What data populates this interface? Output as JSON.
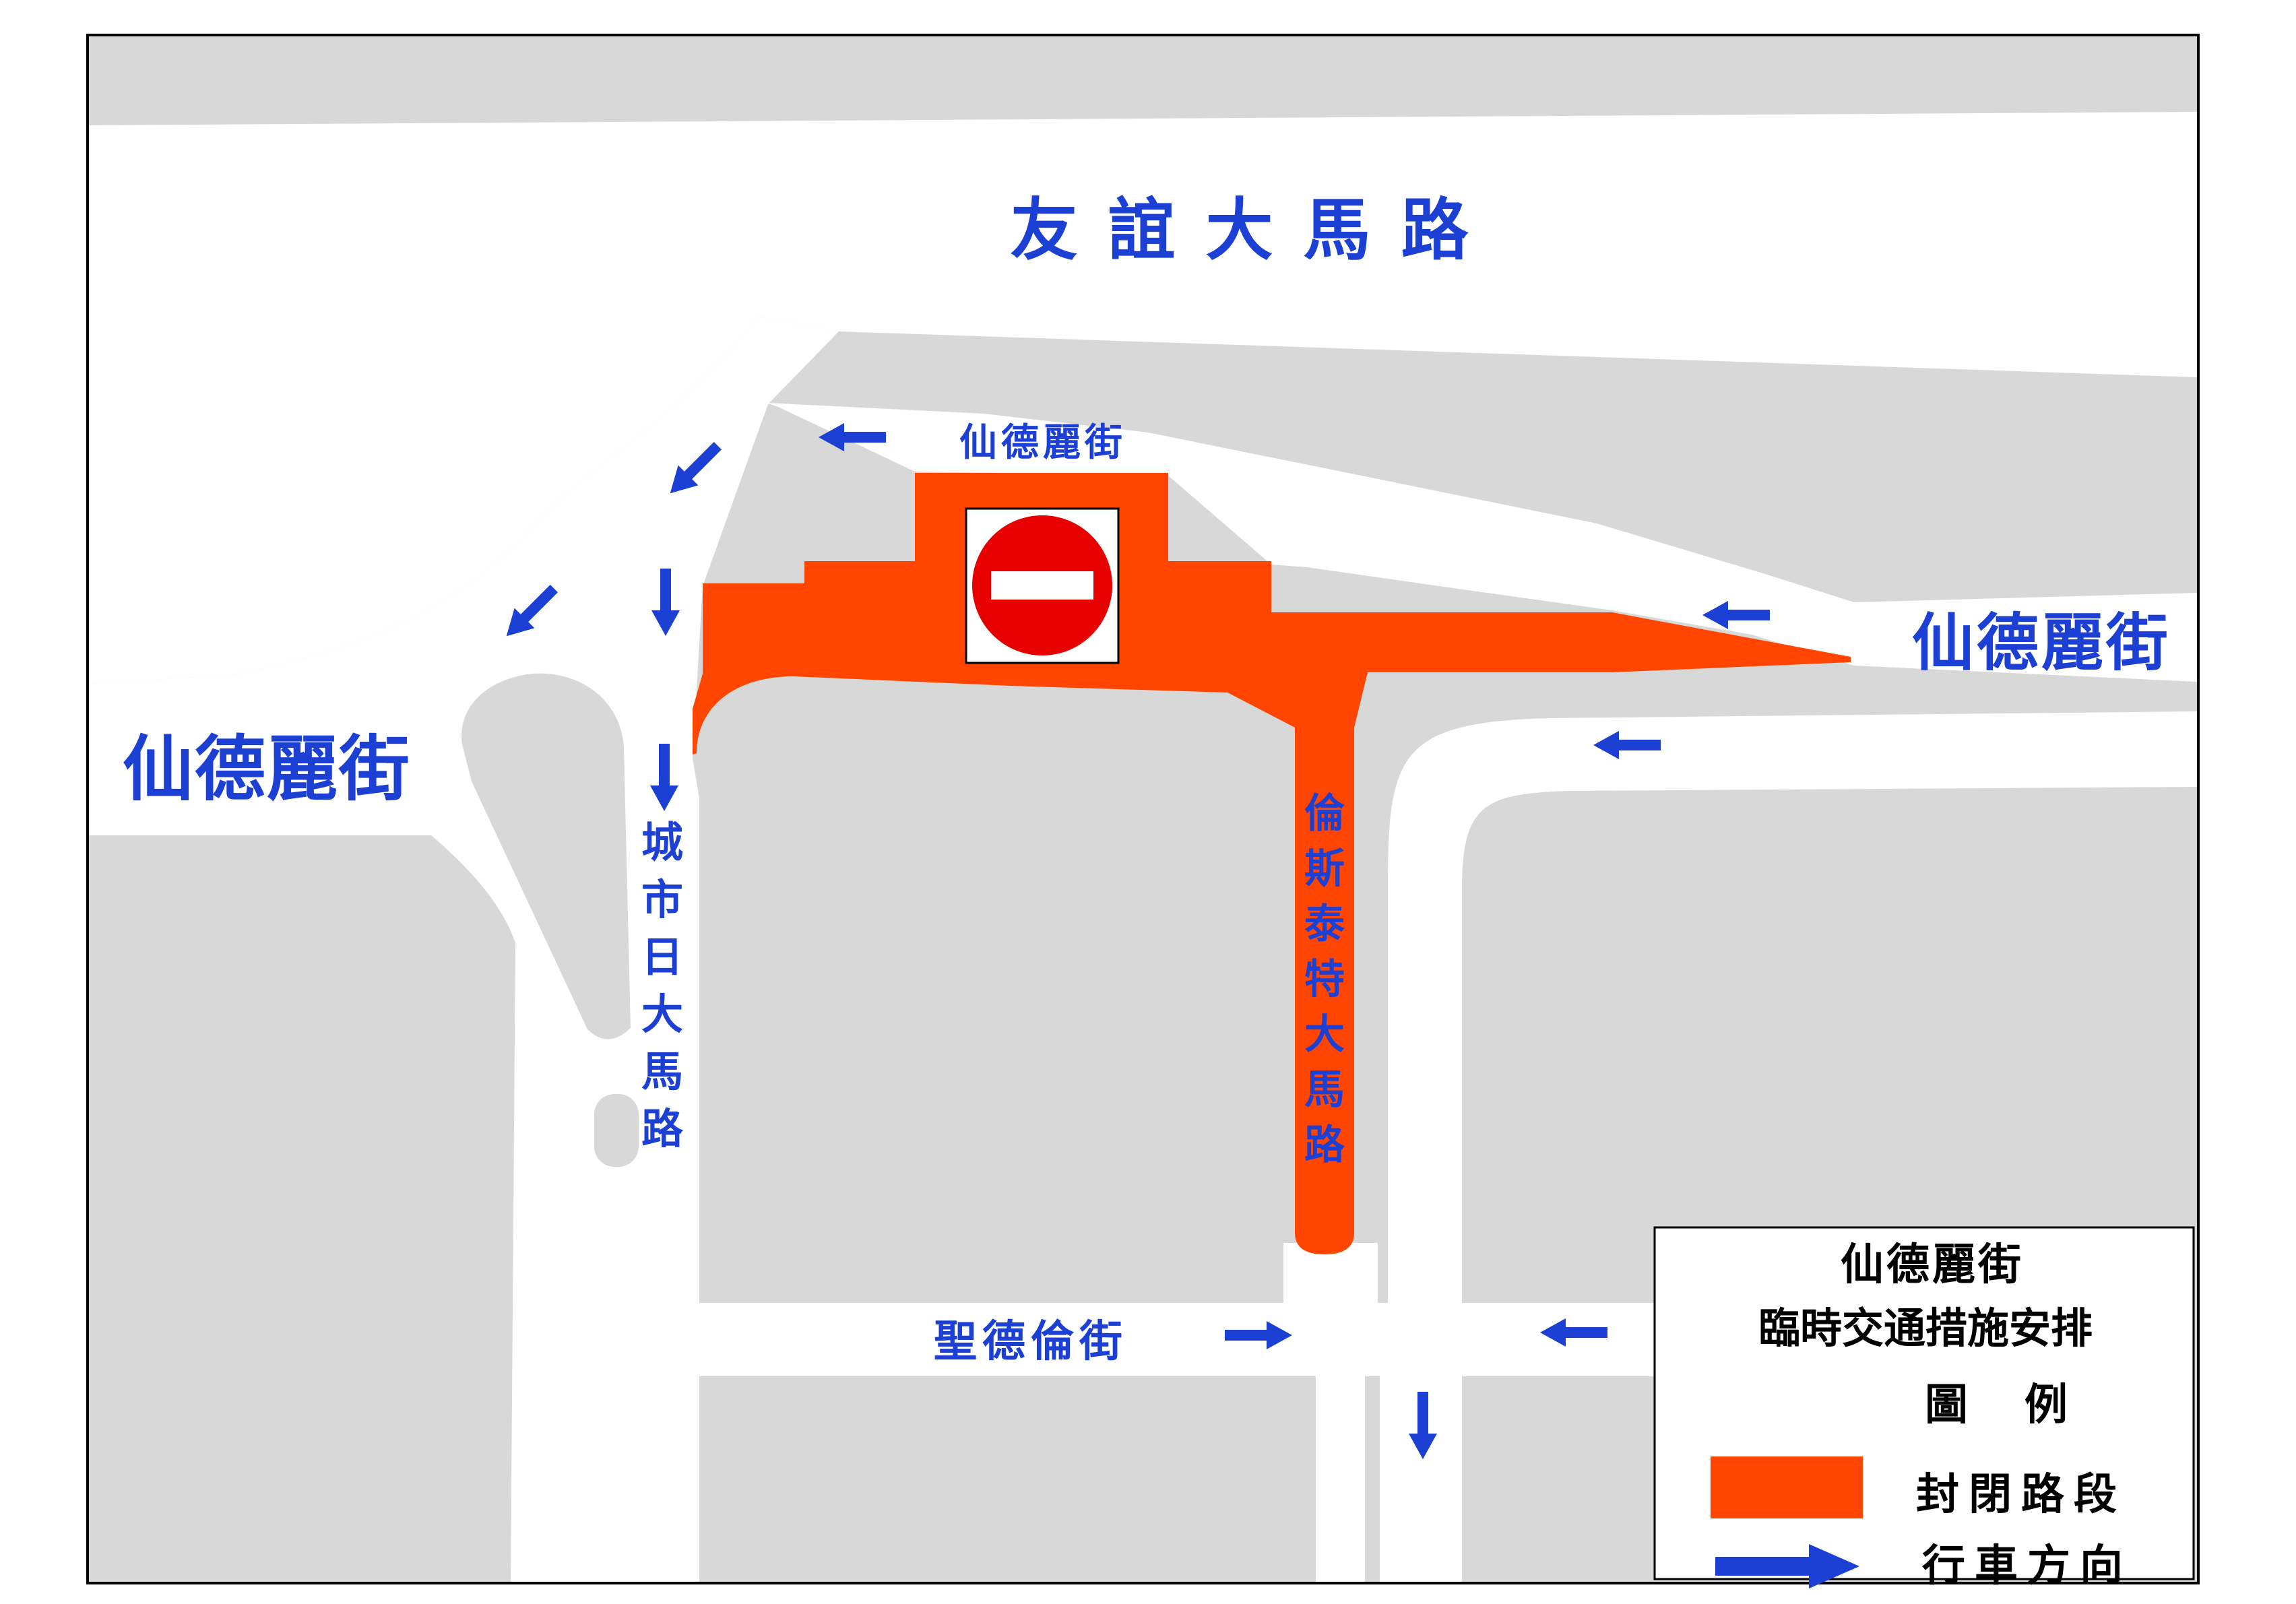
{
  "map": {
    "streets": {
      "youyi_road": "友誼大馬路",
      "xiandeli_small": "仙德麗街",
      "xiandeli_left": "仙德麗街",
      "xiandeli_right": "仙德麗街",
      "chengshiri_road": "城市日大馬路",
      "lunsitaite_road": "倫斯泰特大馬路",
      "shengdelun_street": "聖德倫街"
    },
    "icons": {
      "no_entry_sign": "no-entry-icon",
      "flow_arrow": "direction-arrow-icon"
    }
  },
  "legend": {
    "title_line1": "仙德麗街",
    "title_line2": "臨時交通措施安排",
    "heading": "圖　例",
    "closed_label": "封閉路段",
    "direction_label": "行車方向"
  },
  "colors": {
    "closed_road_orange": "#ff4500",
    "arrow_and_label_blue": "#1c3fd4",
    "block_gray": "#d8d8d8",
    "no_entry_red": "#e60000",
    "road_white": "#ffffff",
    "outline_black": "#000000"
  }
}
